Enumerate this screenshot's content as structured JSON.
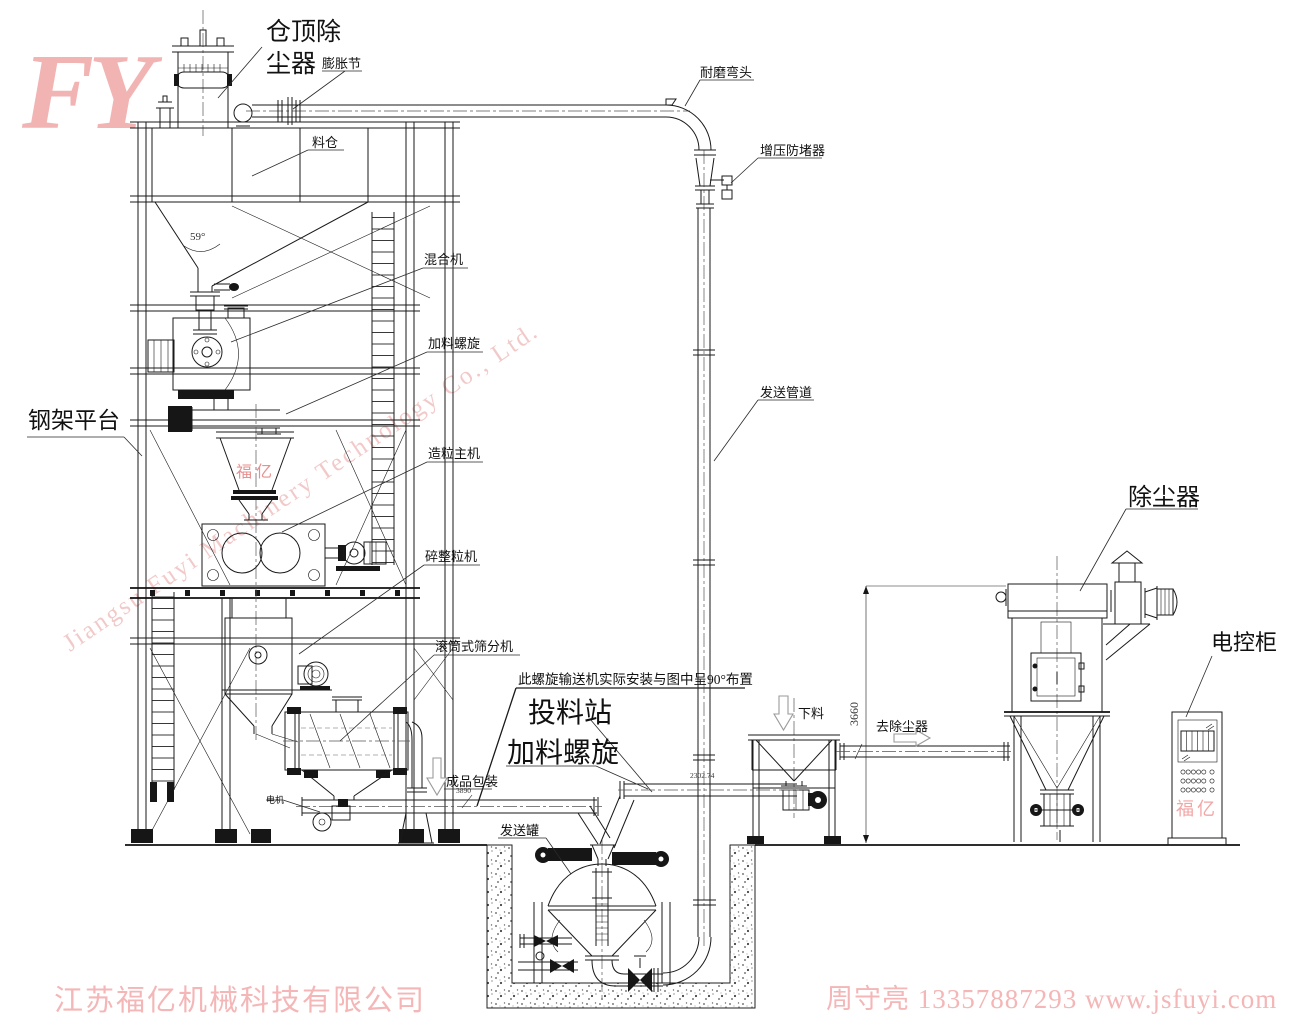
{
  "logo": {
    "text": "FY"
  },
  "watermarks": {
    "diagonal": "Jiangsu Fuyi Machinery Technology Co., Ltd.",
    "brand_hopper": "福亿",
    "brand_cabinet": "福亿"
  },
  "footer": {
    "company": "江苏福亿机械科技有限公司",
    "contact": "周守亮 13357887293 www.jsfuyi.com"
  },
  "labels": {
    "silo_top_dc_line1": "仓顶除",
    "silo_top_dc_line2": "尘器",
    "expansion_joint": "膨胀节",
    "material_silo": "料仓",
    "mixer": "混合机",
    "feed_screw_upper": "加料螺旋",
    "granulator": "造粒主机",
    "crusher": "碎整粒机",
    "steel_platform": "钢架平台",
    "drum_screener": "滚筒式筛分机",
    "wear_elbow": "耐磨弯头",
    "anti_blocker": "增压防堵器",
    "conveying_pipe": "发送管道",
    "screw_note": "此螺旋输送机实际安装与图中呈90°布置",
    "feeding_station": "投料站",
    "feed_screw_lower": "加料螺旋",
    "finished_packing": "成品包装",
    "motor": "电机",
    "sending_tank": "发送罐",
    "discharge_down": "下料",
    "to_dust_collector": "去除尘器",
    "dust_collector": "除尘器",
    "control_cabinet": "电控柜"
  },
  "dimensions": {
    "cone_angle": "59°",
    "height_3660": "3660",
    "conveyor_a": "3890",
    "conveyor_b": "2302.74"
  },
  "colors": {
    "line": "#1a1a1a",
    "brand_pink": "#f4b6b6",
    "brand_red": "#e88f8f",
    "watermark": "#f0bcbc"
  }
}
